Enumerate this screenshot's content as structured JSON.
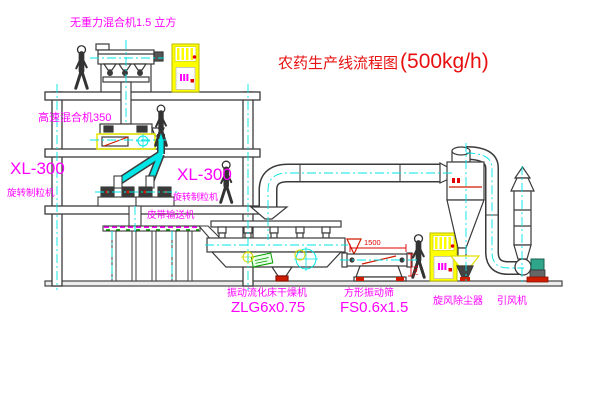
{
  "title": {
    "name": "农药生产线流程图",
    "capacity": "(500kg/h)"
  },
  "equipment_labels": {
    "gravity_mixer": "无重力混合机1.5 立方",
    "high_speed_mixer": "高速混合机350",
    "granulator_left_model": "XL-300",
    "granulator_left_name": "旋转制粒机",
    "granulator_right_model": "XL-300",
    "granulator_right_name": "旋转制粒机",
    "belt_conveyor": "皮带输送机",
    "fluid_bed_dryer_name": "振动流化床干燥机",
    "fluid_bed_dryer_model": "ZLG6x0.75",
    "vibrating_sieve_name": "方形振动筛",
    "vibrating_sieve_model": "FS0.6x1.5",
    "cyclone_dust_collector": "旋风除尘器",
    "induced_draft_fan": "引风机"
  },
  "dimensions": {
    "sieve_length_mm": "1500",
    "sieve_height_mm": "741"
  },
  "colors": {
    "label": "#ff00ff",
    "title": "#e81010",
    "centerline": "#00e5e5",
    "cabinet_yellow": "#ffff00",
    "accent_red": "#cf1b00",
    "accent_green": "#0aa000",
    "line_dark": "#3a3a3a",
    "dimension_red": "#e00000"
  }
}
